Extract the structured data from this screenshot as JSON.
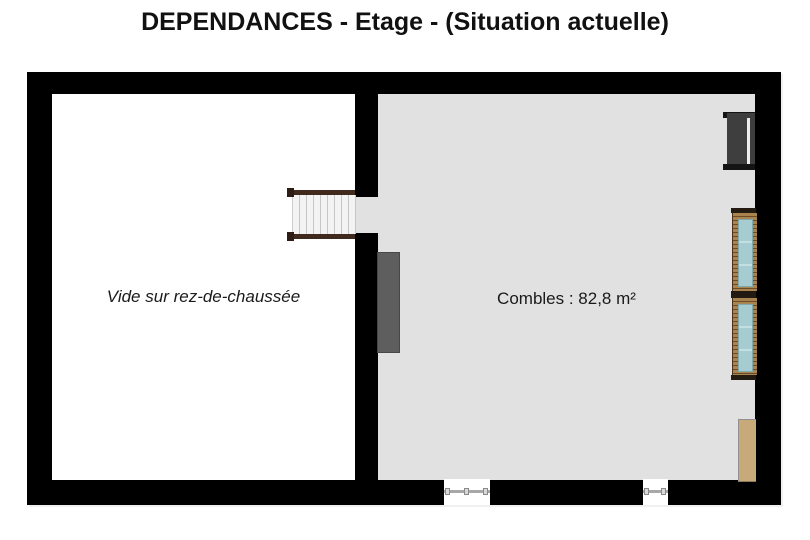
{
  "title": "DEPENDANCES - Etage - (Situation actuelle)",
  "plan": {
    "left_room": {
      "label": "Vide sur rez-de-chaussée"
    },
    "right_room": {
      "label": "Combles : 82,8 m²",
      "area_m2": "82,8"
    }
  },
  "colors": {
    "wall": "#000000",
    "left_room_floor": "#ffffff",
    "right_room_floor": "#e1e1e1",
    "stair_rail_brown": "#40291d",
    "stair_tread": "#f3f3f3",
    "window_frame_wood": "#aa844e",
    "window_glass_teal": "#a6ccd1",
    "dark_panel": "#3e3e3e",
    "chimney_gray": "#5e5e5e",
    "cabinet_tan": "#c8a97a"
  }
}
